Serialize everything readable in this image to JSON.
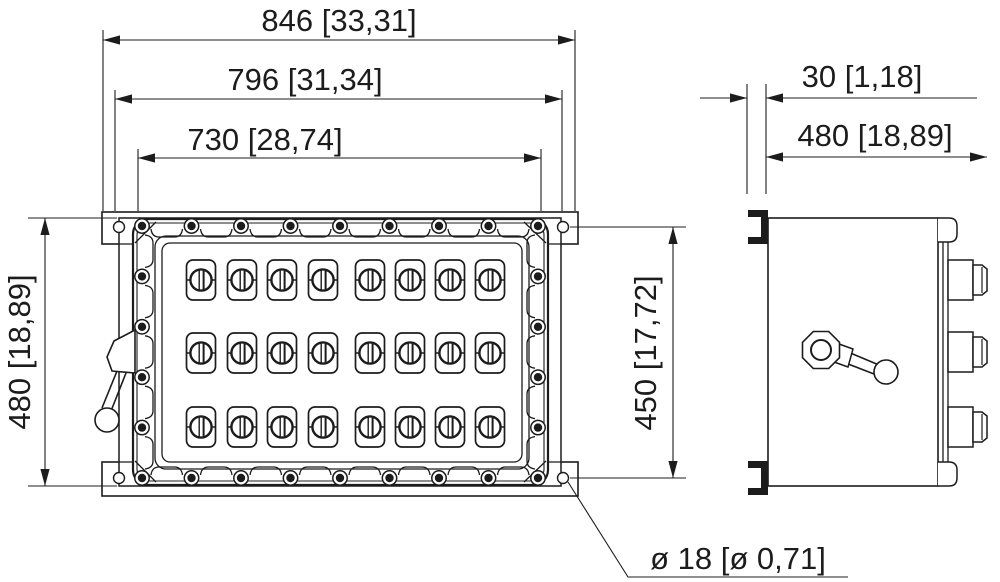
{
  "drawing": {
    "kind": "enclosure dimension drawing",
    "dimensions": {
      "overall_width": "846 [33,31]",
      "enclosure_width": "796 [31,34]",
      "cover_width": "730 [28,74]",
      "enclosure_height": "480 [18,89]",
      "mounting_hole_spacing": "450 [17,72]",
      "flange_thickness": "30 [1,18]",
      "overall_depth": "480 [18,89]",
      "mounting_hole_diameter": "ø 18 [ø 0,71]"
    },
    "front_view": {
      "switch_rows": 3,
      "switch_columns": 8,
      "cover_bolts": 26,
      "mounting_holes": 4
    },
    "side_view": {
      "cable_glands": 3,
      "flange_clamps": 2
    },
    "colors": {
      "line": "#1c1c1c",
      "background": "#ffffff"
    }
  }
}
